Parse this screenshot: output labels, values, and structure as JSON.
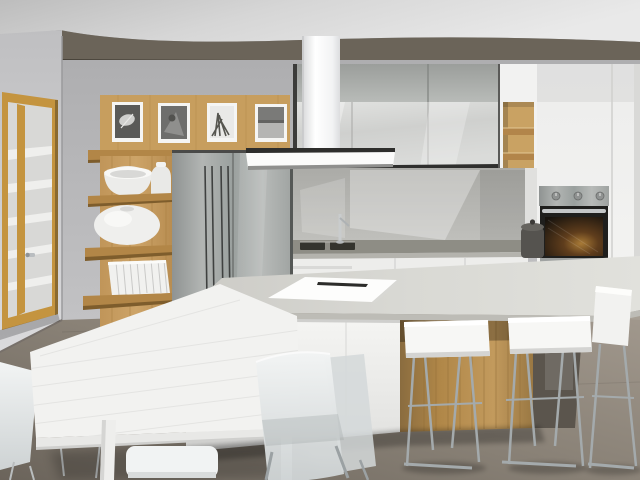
{
  "scene": {
    "type": "architectural-3d-render",
    "subject": "modern open-plan kitchen with island and dining table",
    "contains_text": false,
    "palette": {
      "ceiling": "#d6d6d6",
      "soffit": "#6b6459",
      "wall_left": "#c9c9cb",
      "wall_back": "#b5b5b7",
      "wood": "#c79e5e",
      "wood_shelf": "#b28647",
      "wood_recess": "#b98d50",
      "stainless": "#a5a9a7",
      "cabinet_white": "#f2f2f1",
      "cabinet_gloss": "#cfd0ce",
      "counter_dark": "#8e8d85",
      "island_top": "#d9d9d4",
      "island_white": "#f3f3f1",
      "sink_dark": "#34342e",
      "oven_door": "#1f1f1d",
      "oven_glow": "#a87a36",
      "canister": "#55534f",
      "stool_white": "#f7f7f5",
      "table_white": "#f2f2f0",
      "chair_white": "#eef0f1",
      "chrome": "#a4aaac",
      "floor": "#8a8277"
    },
    "objects": [
      {
        "name": "ceiling",
        "desc": "grey-white plaster ceiling"
      },
      {
        "name": "soffit",
        "desc": "dark taupe dropped soffit above the cabinetry"
      },
      {
        "name": "pantry-door",
        "desc": "oak framed glass door at left with chrome handle, white shelves visible through glass"
      },
      {
        "name": "gallery-shelf",
        "desc": "oak panel and ledge holding framed monochrome artworks",
        "artwork_count": 4
      },
      {
        "name": "display-shelves",
        "desc": "four oak wall shelves with white bowl, white vases and a row of white binders",
        "binder_count": 9
      },
      {
        "name": "refrigerator",
        "desc": "built-in stainless steel double door fridge with vertical bar handles"
      },
      {
        "name": "range-hood",
        "desc": "white chimney extractor hood over the worktop"
      },
      {
        "name": "upper-cabinets",
        "desc": "two-tone glossy grey wall cabinets"
      },
      {
        "name": "wood-niche",
        "desc": "open oak shelf niche set between white columns"
      },
      {
        "name": "backsplash",
        "desc": "grey glass splashback with angular reflections"
      },
      {
        "name": "countertop",
        "desc": "dark grey worktop with double undermount sink and chrome mixer tap"
      },
      {
        "name": "base-cabinets",
        "desc": "handleless white drawer units"
      },
      {
        "name": "oven",
        "desc": "built-in stainless steel oven with three knobs and warm lit interior",
        "knob_count": 3
      },
      {
        "name": "canister",
        "desc": "dark grey lidded jar on the worktop"
      },
      {
        "name": "island",
        "desc": "white kitchen island with grey top, oak panelled seating recess and white cover sheet on top"
      },
      {
        "name": "bar-stools",
        "desc": "white bar stools with chrome sled legs at the island",
        "count": 3
      },
      {
        "name": "dining-table",
        "desc": "long white rectangular dining table"
      },
      {
        "name": "dining-chairs",
        "desc": "white shell chairs with thin metal legs around the table",
        "count": 6
      },
      {
        "name": "floor",
        "desc": "grey-brown screed floor"
      }
    ]
  }
}
